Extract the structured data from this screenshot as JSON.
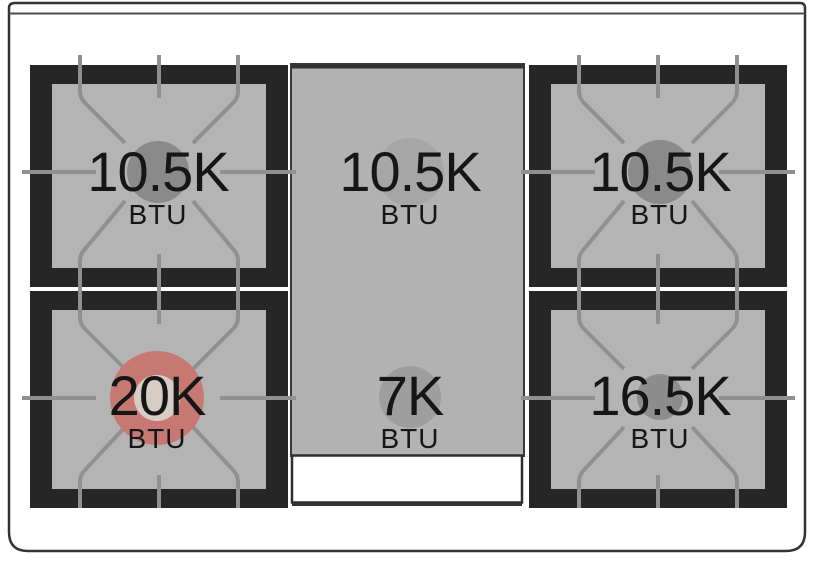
{
  "diagram": {
    "burners": {
      "rear_left": {
        "power": "10.5K",
        "unit": "BTU"
      },
      "rear_center": {
        "power": "10.5K",
        "unit": "BTU"
      },
      "rear_right": {
        "power": "10.5K",
        "unit": "BTU"
      },
      "front_left": {
        "power": "20K",
        "unit": "BTU",
        "highlighted": true
      },
      "front_center": {
        "power": "7K",
        "unit": "BTU"
      },
      "front_right": {
        "power": "16.5K",
        "unit": "BTU"
      }
    },
    "colors": {
      "frame": "#262626",
      "pan": "#b4b4b4",
      "griddle": "#b2b2b2",
      "line": "#909090",
      "circle_dark": "#8a8a8a",
      "circle_soft": "#a6a6a6",
      "circle_mid": "#9e9e9e",
      "circle_small": "#8d8d8d",
      "ring_outer": "#c87873",
      "ring_inner": "#d8ccc6",
      "outline": "#333333",
      "text_primary": "#161616",
      "tray": "#ffffff"
    }
  }
}
